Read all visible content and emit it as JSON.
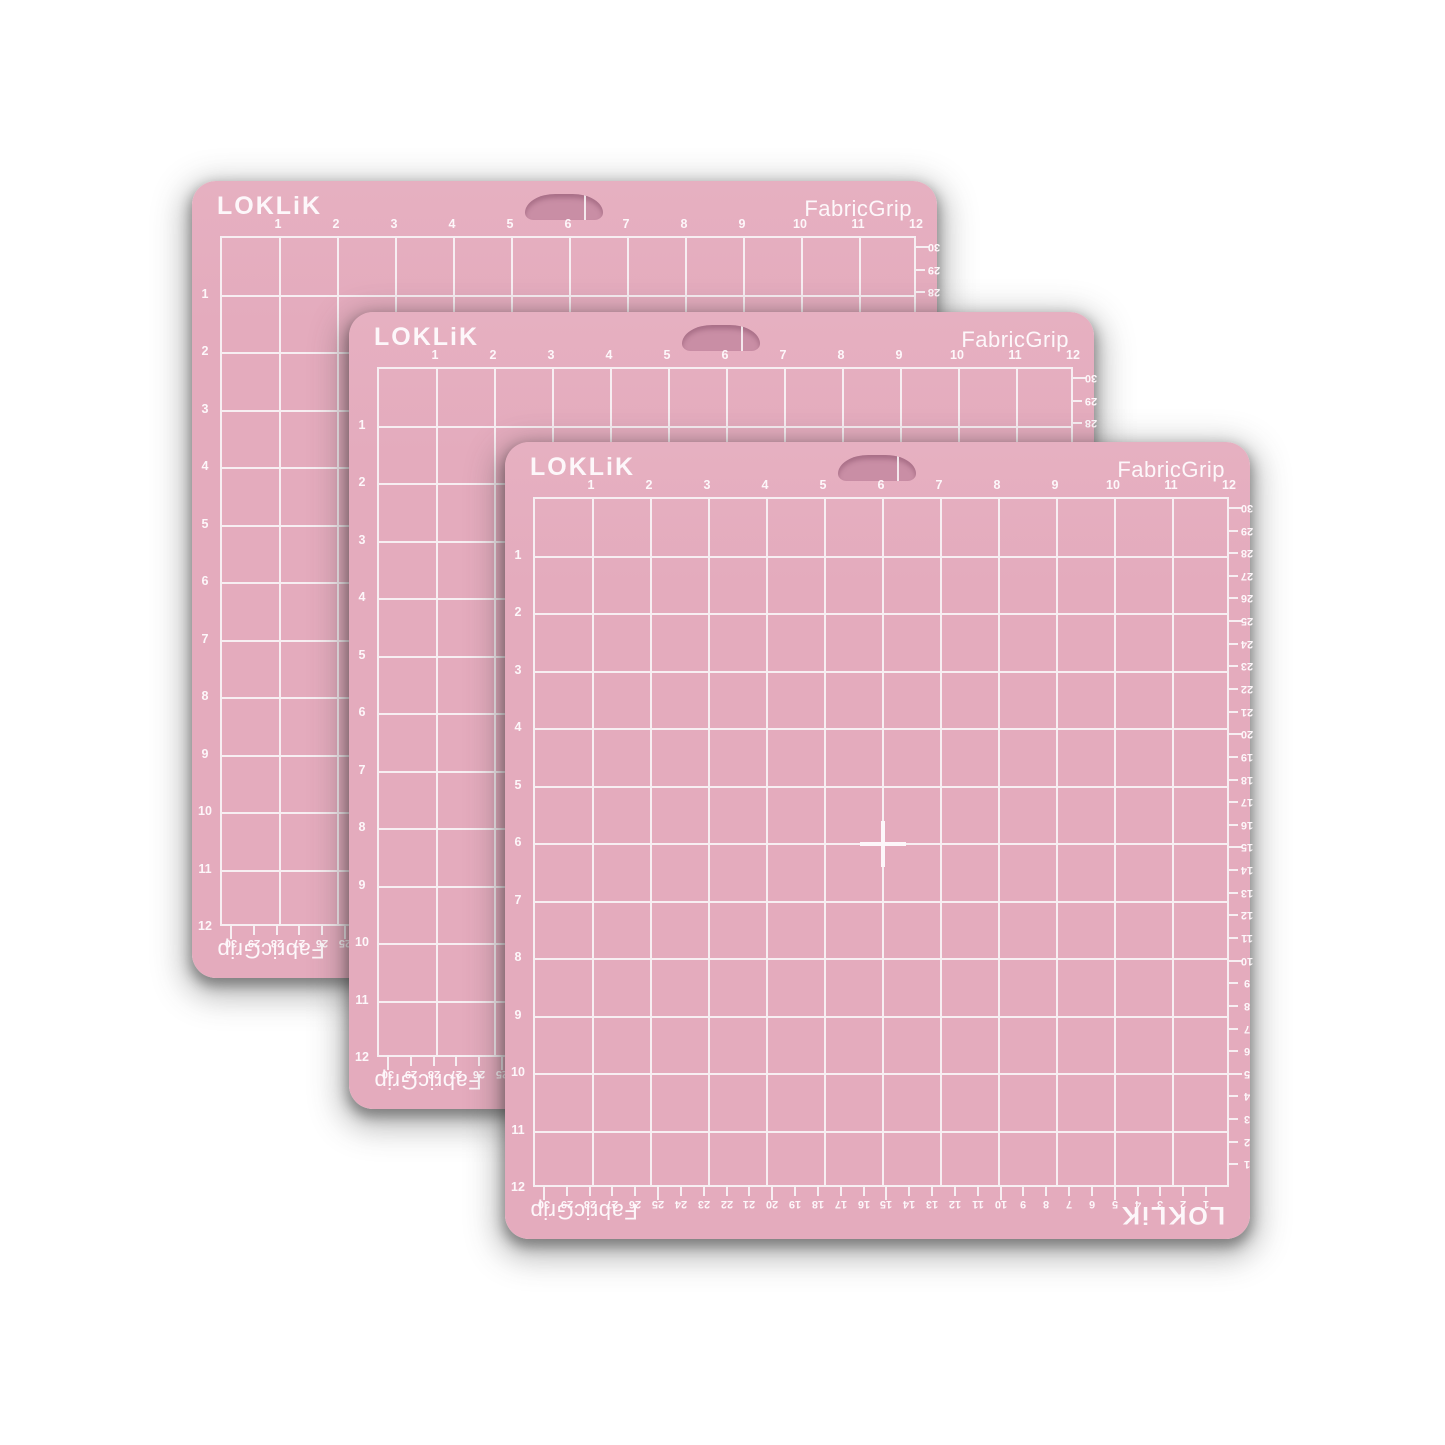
{
  "background_color": "#ffffff",
  "mat": {
    "brand": "LOKLiK",
    "product": "FabricGrip",
    "bottom_brand": "LOKLiK",
    "bottom_product": "FabricGrip",
    "colors": {
      "base": "#e4abbd",
      "hole": "#c98ea5",
      "grid_line": "#f7eef2",
      "label_text": "#fdf7fa",
      "shadow": "rgba(70,70,70,0.4)"
    },
    "inch_labels_top": [
      "1",
      "2",
      "3",
      "4",
      "5",
      "6",
      "7",
      "8",
      "9",
      "10",
      "11",
      "12"
    ],
    "inch_labels_left": [
      "1",
      "2",
      "3",
      "4",
      "5",
      "6",
      "7",
      "8",
      "9",
      "10",
      "11",
      "12"
    ],
    "cm_labels_right": [
      "30",
      "29",
      "28",
      "27",
      "26",
      "25",
      "24",
      "23",
      "22",
      "21",
      "20",
      "19",
      "18",
      "17",
      "16",
      "15",
      "14",
      "13",
      "12",
      "11",
      "10",
      "9",
      "8",
      "7",
      "6",
      "5",
      "4",
      "3",
      "2",
      "1"
    ],
    "cm_labels_bottom": [
      "30",
      "29",
      "28",
      "27",
      "26",
      "25",
      "24",
      "23",
      "22",
      "21",
      "20",
      "19",
      "18",
      "17",
      "16",
      "15",
      "14",
      "13",
      "12",
      "11",
      "10",
      "9",
      "8",
      "7",
      "6",
      "5",
      "4",
      "3",
      "2",
      "1"
    ]
  },
  "mats": [
    {
      "name": "back-mat"
    },
    {
      "name": "middle-mat"
    },
    {
      "name": "front-mat"
    }
  ]
}
